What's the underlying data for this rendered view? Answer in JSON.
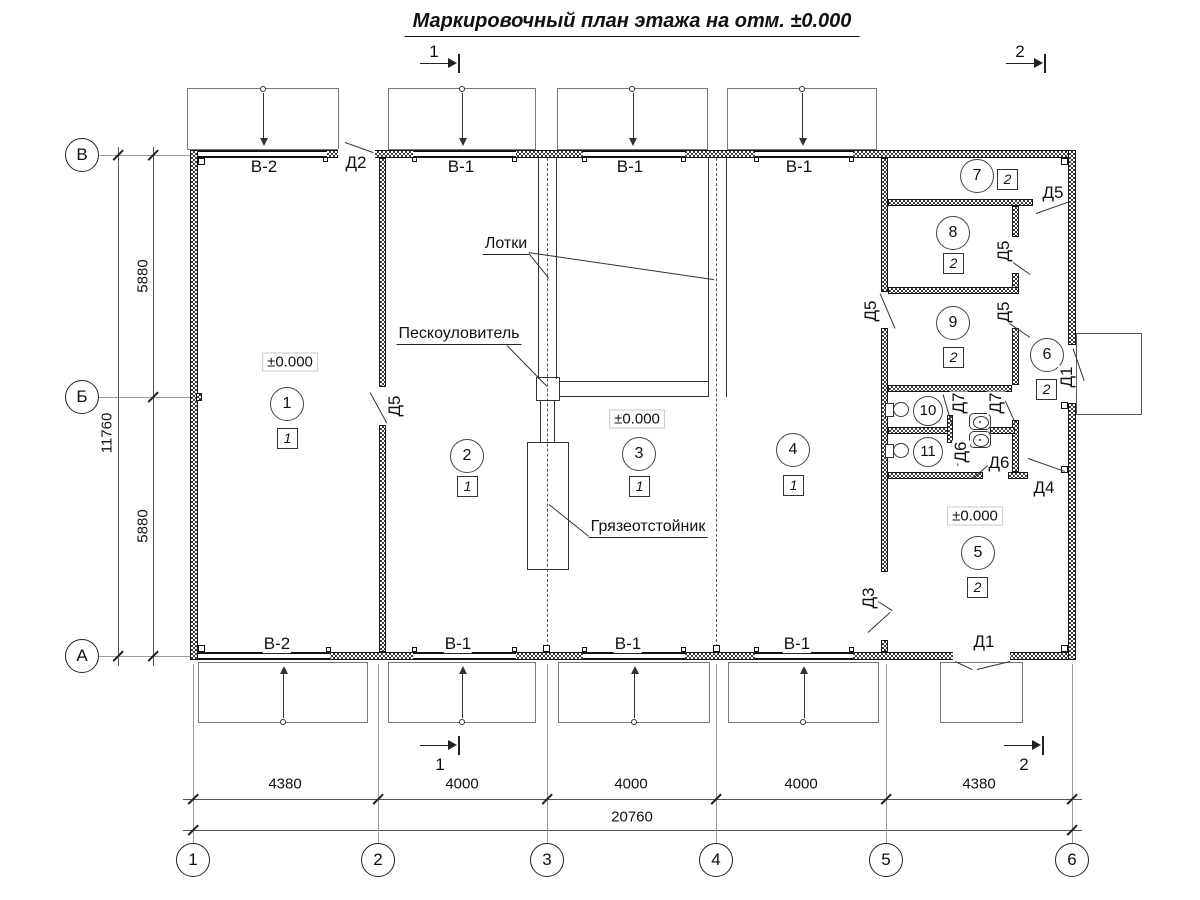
{
  "title": "Маркировочный план этажа на отм. ±0.000",
  "sections": {
    "top_left": "1",
    "top_right": "2",
    "bottom_left": "1",
    "bottom_right": "2"
  },
  "grid": {
    "columns": [
      {
        "label": "1",
        "x": 193
      },
      {
        "label": "2",
        "x": 378
      },
      {
        "label": "3",
        "x": 547
      },
      {
        "label": "4",
        "x": 716
      },
      {
        "label": "5",
        "x": 886
      },
      {
        "label": "6",
        "x": 1072
      }
    ],
    "rows": [
      {
        "label": "В",
        "y": 155
      },
      {
        "label": "Б",
        "y": 397
      },
      {
        "label": "А",
        "y": 656
      }
    ]
  },
  "dimensions": {
    "bottom_segments": [
      {
        "text": "4380",
        "cx": 285
      },
      {
        "text": "4000",
        "cx": 462
      },
      {
        "text": "4000",
        "cx": 631
      },
      {
        "text": "4000",
        "cx": 801
      },
      {
        "text": "4380",
        "cx": 979
      }
    ],
    "bottom_total": {
      "text": "20760",
      "cx": 632
    },
    "left_segments": [
      {
        "text": "5880",
        "cy": 276
      },
      {
        "text": "5880",
        "cy": 526
      }
    ],
    "left_total": {
      "text": "11760",
      "cy": 433
    }
  },
  "rooms": [
    {
      "number": "1",
      "cx": 287,
      "cy": 404,
      "box": "1",
      "bx": 287,
      "by": 438,
      "elevation": "±0.000",
      "ex": 290,
      "ey": 362
    },
    {
      "number": "2",
      "cx": 467,
      "cy": 456,
      "box": "1",
      "bx": 467,
      "by": 486
    },
    {
      "number": "3",
      "cx": 639,
      "cy": 454,
      "box": "1",
      "bx": 639,
      "by": 486,
      "elevation": "±0.000",
      "ex": 637,
      "ey": 419
    },
    {
      "number": "4",
      "cx": 793,
      "cy": 450,
      "box": "1",
      "bx": 793,
      "by": 485
    },
    {
      "number": "5",
      "cx": 978,
      "cy": 553,
      "box": "2",
      "bx": 977,
      "by": 587,
      "elevation": "±0.000",
      "ex": 975,
      "ey": 516
    },
    {
      "number": "6",
      "cx": 1047,
      "cy": 355,
      "box": "2",
      "bx": 1046,
      "by": 389
    },
    {
      "number": "7",
      "cx": 977,
      "cy": 176,
      "box": "2",
      "bx": 1007,
      "by": 179
    },
    {
      "number": "8",
      "cx": 953,
      "cy": 233,
      "box": "2",
      "bx": 953,
      "by": 263
    },
    {
      "number": "9",
      "cx": 953,
      "cy": 323,
      "box": "2",
      "bx": 953,
      "by": 357
    },
    {
      "number": "10",
      "cx": 928,
      "cy": 411,
      "small": true
    },
    {
      "number": "11",
      "cx": 928,
      "cy": 452,
      "small": true
    }
  ],
  "windows": [
    {
      "label": "В-2",
      "x": 264,
      "y": 167
    },
    {
      "label": "В-1",
      "x": 461,
      "y": 167
    },
    {
      "label": "В-1",
      "x": 630,
      "y": 167
    },
    {
      "label": "В-1",
      "x": 799,
      "y": 167
    },
    {
      "label": "В-2",
      "x": 277,
      "y": 644
    },
    {
      "label": "В-1",
      "x": 458,
      "y": 644
    },
    {
      "label": "В-1",
      "x": 628,
      "y": 644
    },
    {
      "label": "В-1",
      "x": 797,
      "y": 644
    }
  ],
  "doors": [
    {
      "label": "Д2",
      "x": 356,
      "y": 163
    },
    {
      "label": "Д5",
      "x": 395,
      "y": 406,
      "rot": true
    },
    {
      "label": "Д5",
      "x": 1053,
      "y": 193
    },
    {
      "label": "Д5",
      "x": 1004,
      "y": 251,
      "rot": true
    },
    {
      "label": "Д5",
      "x": 871,
      "y": 311,
      "rot": true
    },
    {
      "label": "Д5",
      "x": 1004,
      "y": 312,
      "rot": true
    },
    {
      "label": "Д7",
      "x": 959,
      "y": 403,
      "rot": true
    },
    {
      "label": "Д7",
      "x": 996,
      "y": 403,
      "rot": true
    },
    {
      "label": "Д6",
      "x": 961,
      "y": 452,
      "rot": true
    },
    {
      "label": "Д6",
      "x": 999,
      "y": 463
    },
    {
      "label": "Д4",
      "x": 1044,
      "y": 488
    },
    {
      "label": "Д1",
      "x": 1067,
      "y": 377,
      "rot": true
    },
    {
      "label": "Д3",
      "x": 869,
      "y": 598,
      "rot": true
    },
    {
      "label": "Д1",
      "x": 984,
      "y": 642
    }
  ],
  "annotations": [
    {
      "text": "Лотки",
      "x": 506,
      "y": 245
    },
    {
      "text": "Пескоуловитель",
      "x": 459,
      "y": 335
    },
    {
      "text": "Грязеотстойник",
      "x": 648,
      "y": 528
    }
  ]
}
